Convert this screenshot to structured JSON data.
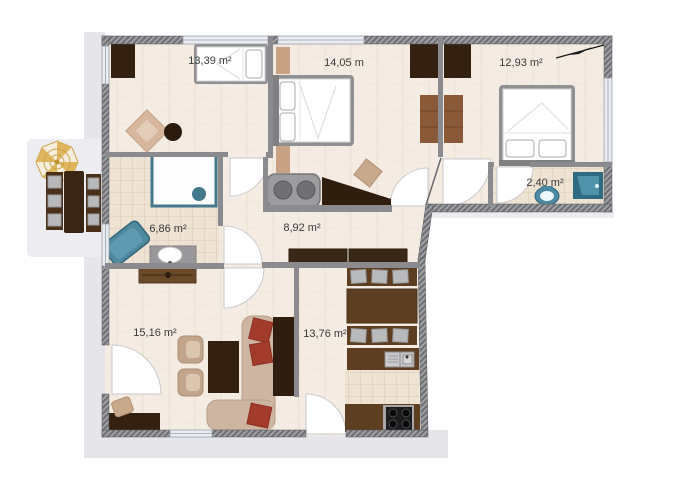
{
  "plan": {
    "rooms": [
      {
        "id": "bedroom-1",
        "area": "13,39 m²"
      },
      {
        "id": "bedroom-2",
        "area": "14,05 m"
      },
      {
        "id": "bedroom-3",
        "area": "12,93 m²"
      },
      {
        "id": "wc",
        "area": "2,40 m²"
      },
      {
        "id": "bathroom",
        "area": "6,86 m²"
      },
      {
        "id": "hallway",
        "area": "8,92 m²"
      },
      {
        "id": "living-room",
        "area": "15,16 m²"
      },
      {
        "id": "kitchen",
        "area": "13,76 m²"
      }
    ],
    "furniture": [
      "wardrobe",
      "single-bed",
      "rug",
      "double-bed",
      "shelf",
      "washing-machine",
      "grand-piano",
      "piano-stool",
      "shower",
      "bathtub",
      "bathroom-sink",
      "hallway-cabinet",
      "toilet",
      "shower-tray",
      "sofa",
      "red-cushion",
      "armchair",
      "coffee-table",
      "tv-cabinet",
      "sideboard",
      "desk",
      "desk-chair",
      "dining-chairs",
      "dining-table",
      "kitchen-sink",
      "stove",
      "parasol",
      "balcony-table",
      "balcony-chairs",
      "north-arrow"
    ],
    "colors": {
      "wall_hatch_dark": "#6e6f73",
      "wall_hatch_light": "#9fa0a4",
      "interior_wall": "#8b8b8f",
      "floor": "#f4ecE3",
      "tile": "#eee2d3",
      "terrace": "#e6e6ea",
      "wood_dark": "#33200f",
      "wood_medium": "#8a5a38",
      "wood_kitchen": "#5d3e20",
      "tan": "#c9a98c",
      "upholstery": "#cdb5a2",
      "accent_red": "#a33b2b",
      "accent_teal": "#44788c",
      "parasol_gold": "#dfb65e"
    }
  }
}
